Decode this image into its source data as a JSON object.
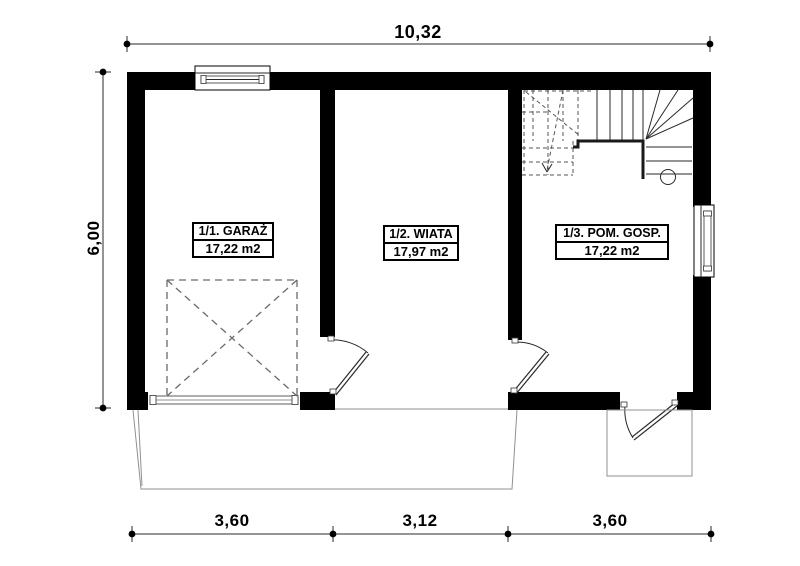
{
  "drawing": {
    "type": "floor-plan",
    "storey_label": "ground floor"
  },
  "dimensions": {
    "top": "10,32",
    "left": "6,00",
    "bottom": [
      "3,60",
      "3,12",
      "3,60"
    ]
  },
  "rooms": [
    {
      "number": "1/1",
      "name": "1/1. GARAŻ",
      "area": "17,22 m2"
    },
    {
      "number": "1/2",
      "name": "1/2. WIATA",
      "area": "17,97 m2"
    },
    {
      "number": "1/3",
      "name": "1/3. POM. GOSP.",
      "area": "17,22 m2"
    }
  ],
  "symbols": {
    "garage_door": "sectional-garage-door",
    "garage_clearance": "dashed-x-square",
    "stairs": "winder-staircase-quarter-turn",
    "doors": [
      "garage-to-wiata-door",
      "wiata-to-pom-gosp-door",
      "pom-gosp-exterior-door"
    ],
    "windows": [
      "garage-top-window",
      "pom-gosp-right-window"
    ],
    "outdoor": [
      "driveway-apron",
      "entry-step"
    ]
  },
  "colors": {
    "wall": "#000000",
    "line": "#2a2a2a",
    "thin": "#909090",
    "dashed": "#6a6a6a",
    "bg": "#ffffff"
  }
}
